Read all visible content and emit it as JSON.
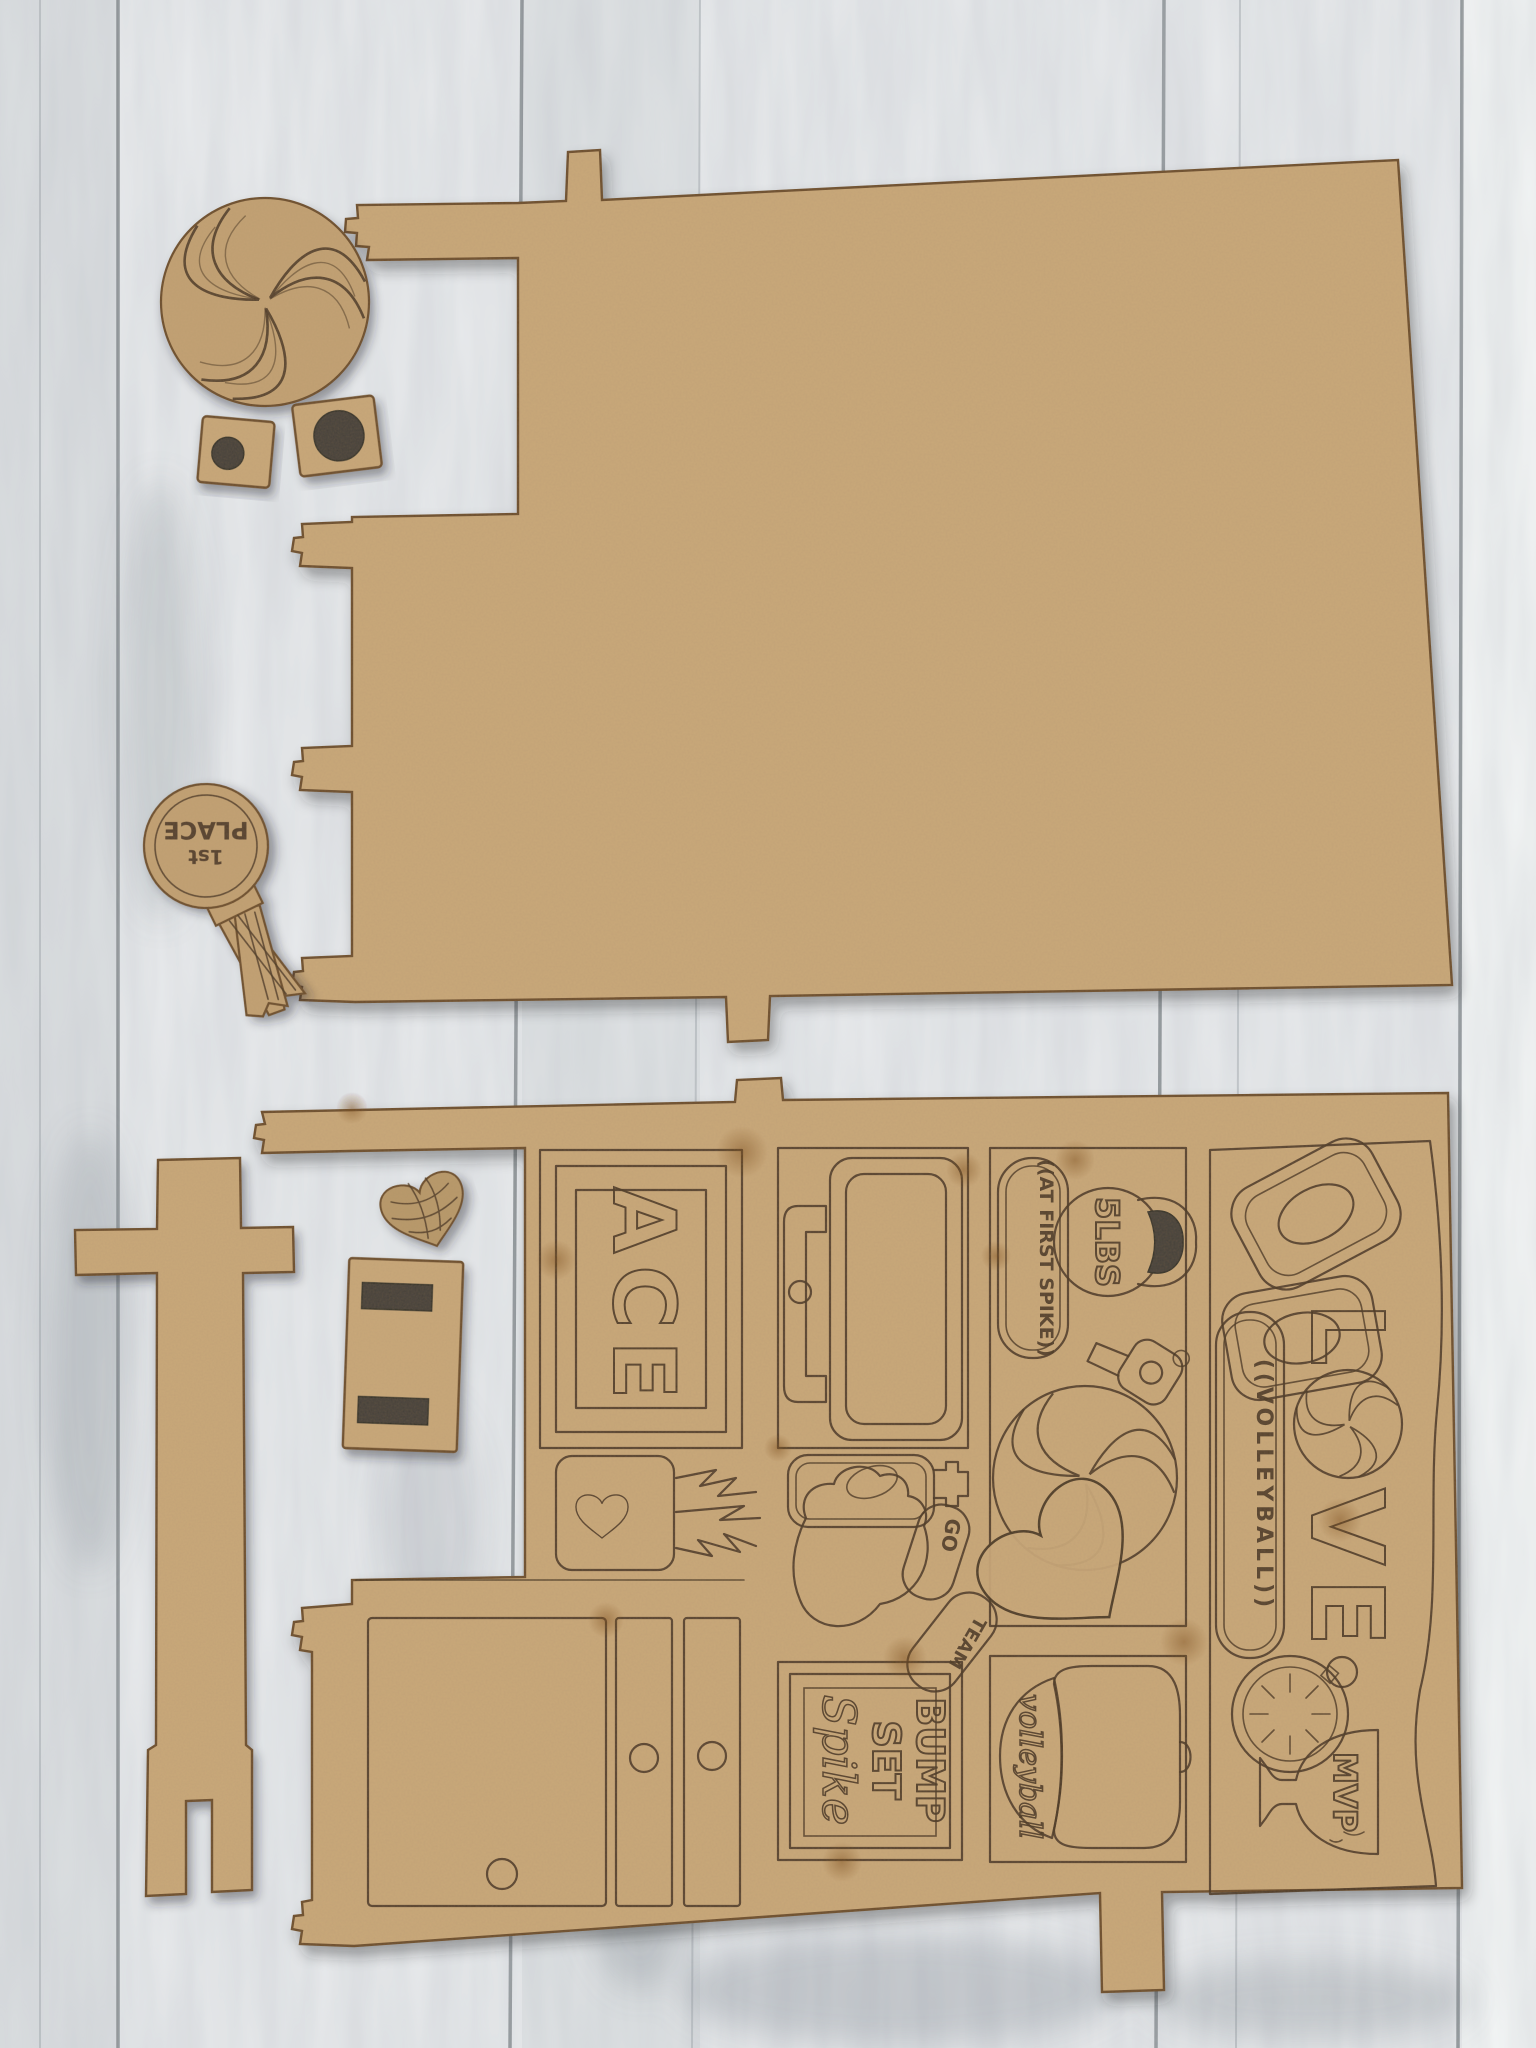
{
  "photo": {
    "colors": {
      "background": "#e8eaec",
      "plank_gap": "#4a5055",
      "mdf_face": "#c9a87a",
      "mdf_edge": "#6e4f2e",
      "engraving": "#4a3726",
      "cut_hole": "#45403b",
      "right_plank_highlight": "#f3f5f5"
    },
    "award_ribbon": {
      "line_top": "1st",
      "line_bottom": "PLACE"
    },
    "ace_sign": {
      "text": "ACE"
    },
    "kettlebell": {
      "label": "5LBS"
    },
    "spike_banner": {
      "text": "((AT FIRST SPIKE))"
    },
    "socks": {
      "sock1": "GO",
      "sock2": "TEAM"
    },
    "bump_sign": {
      "line1": "BUMP",
      "line2": "SET",
      "line3": "Spike"
    },
    "cap": {
      "text": "volleyball"
    },
    "love_banner": {
      "l1": "L",
      "l2": "V",
      "l3": "E",
      "sub": "((VOLLEYBALL))"
    },
    "trophy": {
      "text": "MVP"
    }
  }
}
